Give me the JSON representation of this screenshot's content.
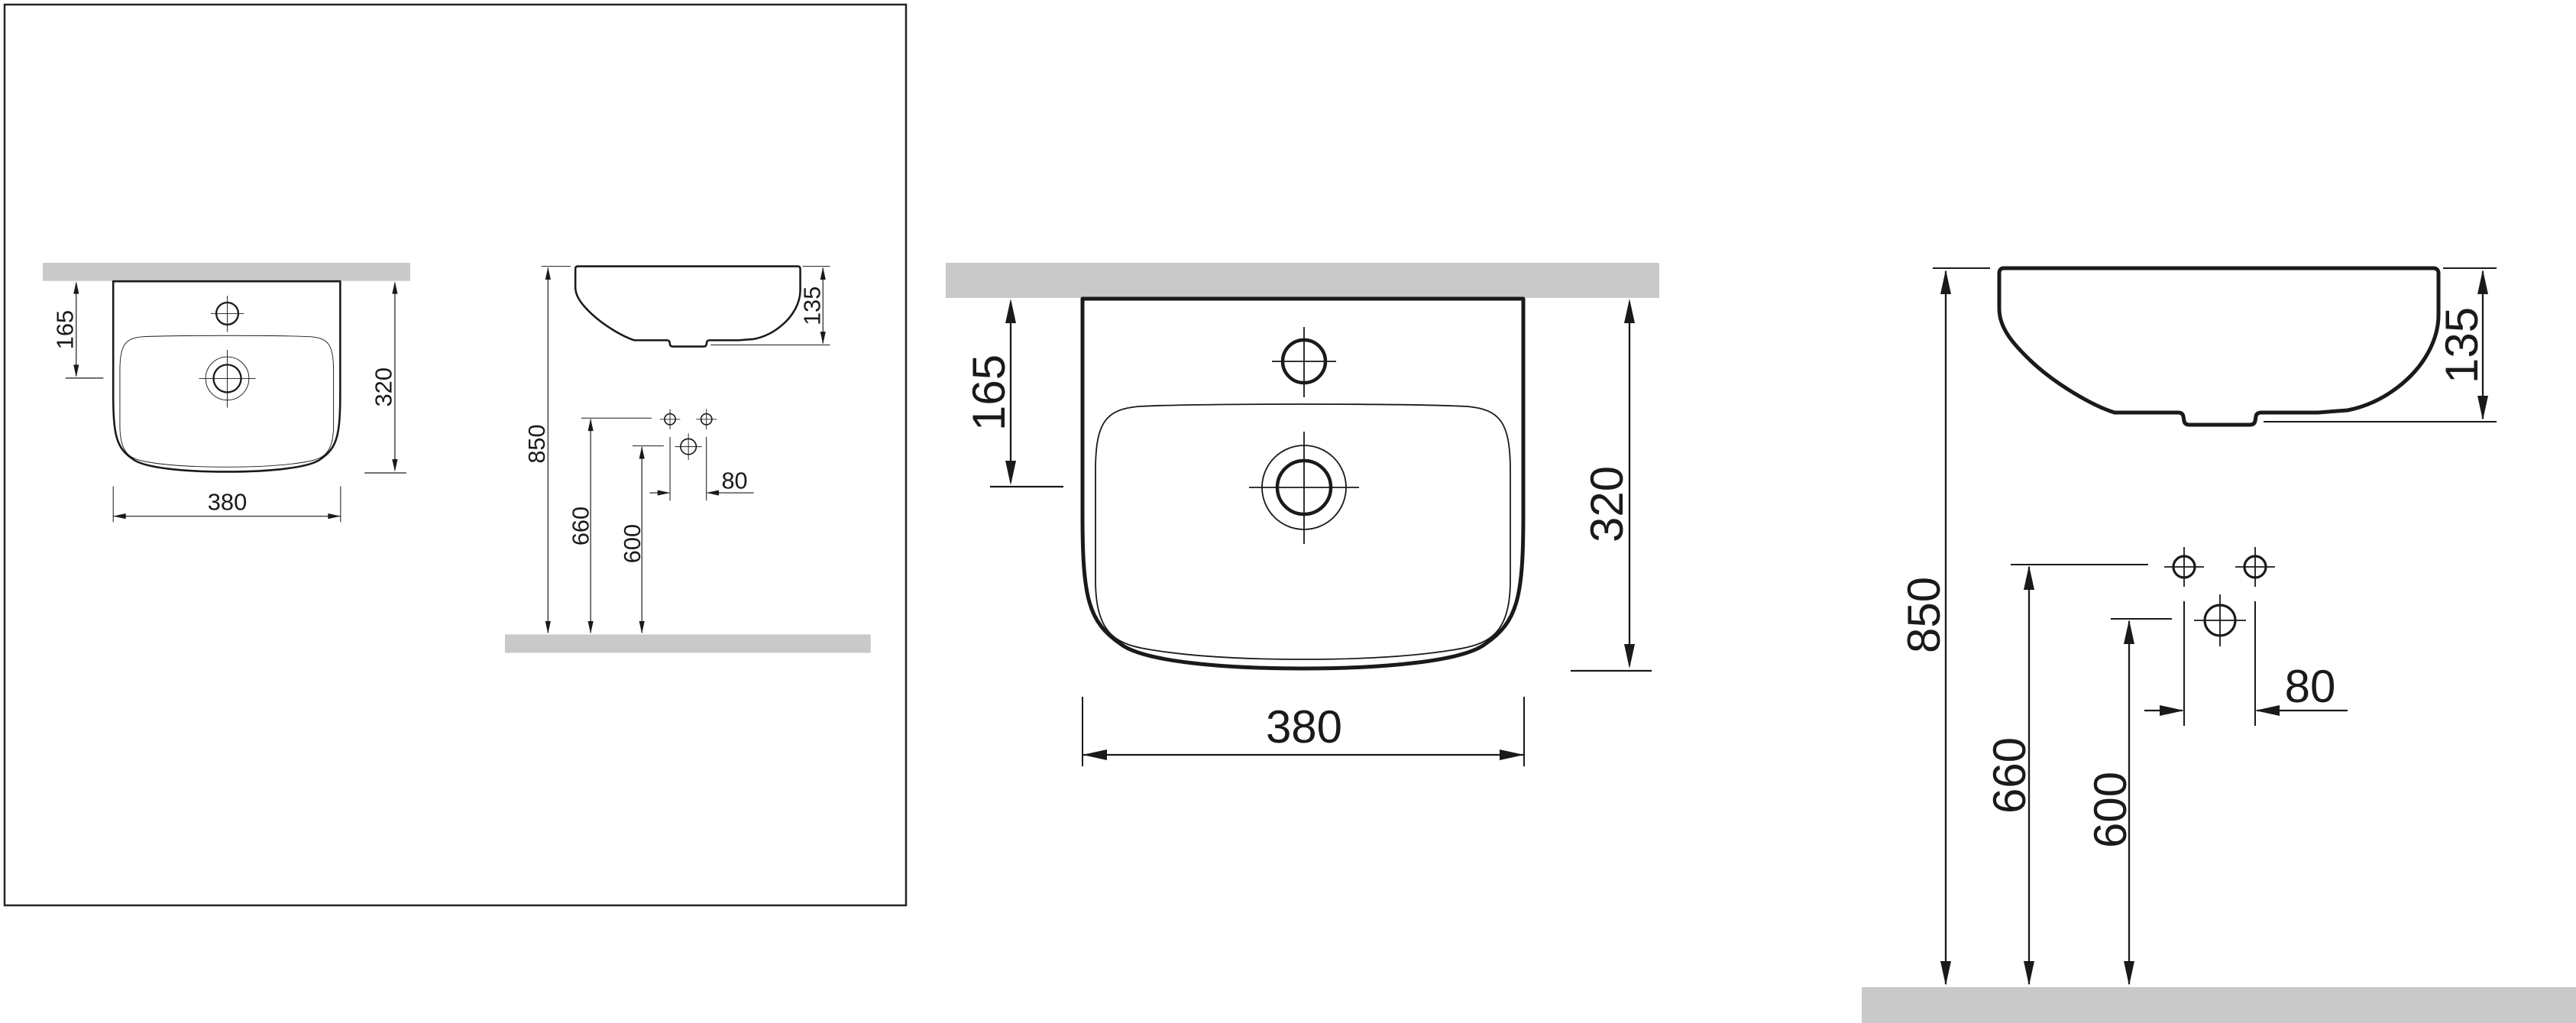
{
  "drawing_title": "wall-hung washbasin installation dimensions",
  "colors": {
    "line": "#1a1a1a",
    "surface_gray": "#c9c9c9",
    "background": "#ffffff"
  },
  "front_view": {
    "dim_faucet_offset": "165",
    "dim_height": "320",
    "dim_width": "380"
  },
  "side_view": {
    "dim_depth": "135",
    "dim_rim_height": "850",
    "dim_holes_height": "660",
    "dim_faucet_height": "600",
    "dim_hole_spacing": "80"
  }
}
